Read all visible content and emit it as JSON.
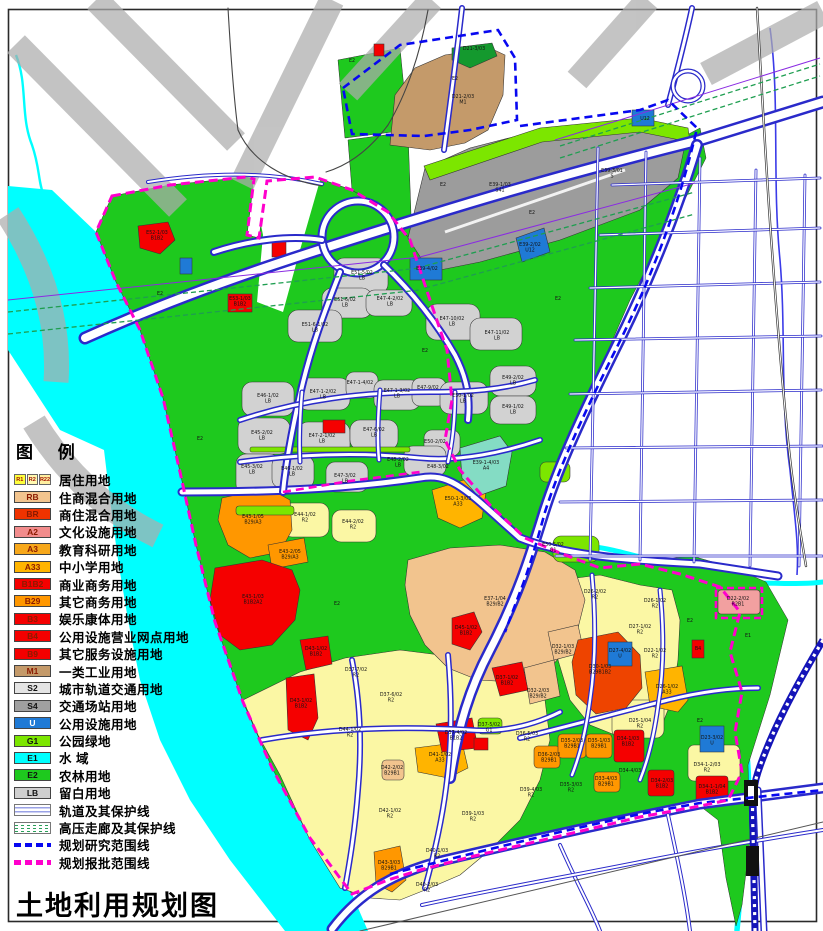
{
  "title": "土地利用规划图",
  "legend": {
    "title": "图 例",
    "items": [
      {
        "type": "swatch3",
        "codes": [
          "R1",
          "R2",
          "R22"
        ],
        "colors": [
          "#FFFF3C",
          "#FFF9B0",
          "#FFEFA0"
        ],
        "label": "居住用地"
      },
      {
        "type": "swatch",
        "code": "RB",
        "color": "#F2C48E",
        "label": "住商混合用地"
      },
      {
        "type": "swatch",
        "code": "BR",
        "color": "#F03300",
        "label": "商住混合用地"
      },
      {
        "type": "swatch",
        "code": "A2",
        "color": "#F28C8C",
        "label": "文化设施用地"
      },
      {
        "type": "swatch",
        "code": "A3",
        "color": "#F7A81B",
        "label": "教育科研用地"
      },
      {
        "type": "swatch",
        "code": "A33",
        "color": "#FFB400",
        "label": "中小学用地"
      },
      {
        "type": "swatch",
        "code": "B1B2",
        "color": "#F50000",
        "label": "商业商务用地"
      },
      {
        "type": "swatch",
        "code": "B29",
        "color": "#FF9700",
        "label": "其它商务用地"
      },
      {
        "type": "swatch",
        "code": "B3",
        "color": "#F50000",
        "label": "娱乐康体用地"
      },
      {
        "type": "swatch",
        "code": "B4",
        "color": "#F50000",
        "label": "公用设施营业网点用地"
      },
      {
        "type": "swatch",
        "code": "B9",
        "color": "#F50000",
        "label": "其它服务设施用地"
      },
      {
        "type": "swatch",
        "code": "M1",
        "color": "#C49A6A",
        "label": "一类工业用地"
      },
      {
        "type": "swatch",
        "code": "S2",
        "color": "#E4E4E4",
        "tc": "#111",
        "label": "城市轨道交通用地"
      },
      {
        "type": "swatch",
        "code": "S4",
        "color": "#A0A0A0",
        "tc": "#111",
        "label": "交通场站用地"
      },
      {
        "type": "swatch",
        "code": "U",
        "color": "#1F7AD6",
        "tc": "#fff",
        "label": "公用设施用地"
      },
      {
        "type": "swatch",
        "code": "G1",
        "color": "#7CE600",
        "tc": "#111",
        "label": "公园绿地"
      },
      {
        "type": "swatch",
        "code": "E1",
        "color": "#00FFFF",
        "tc": "#111",
        "label": "水  域"
      },
      {
        "type": "swatch",
        "code": "E2",
        "color": "#1EC91E",
        "tc": "#111",
        "label": "农林用地"
      },
      {
        "type": "swatch",
        "code": "LB",
        "color": "#CFCFCF",
        "tc": "#111",
        "label": "留白用地"
      },
      {
        "type": "rail",
        "label": "轨道及其保护线"
      },
      {
        "type": "hv",
        "label": "高压走廊及其保护线"
      },
      {
        "type": "dash",
        "color": "#0808F0",
        "label": "规划研究范围线"
      },
      {
        "type": "dash",
        "color": "#FF00CC",
        "label": "规划报批范围线"
      }
    ]
  },
  "colors": {
    "E2": "#1EC91E",
    "G1": "#7CE600",
    "E1": "#00FFFF",
    "LB": "#D2D2D2",
    "S4": "#9C9C9C",
    "M1": "#C49A6A",
    "DG": "#14992E",
    "R2": "#FBF7A4",
    "RB": "#F2C48E",
    "B1B2": "#F50000",
    "B29": "#FF9700",
    "BRR": "#EE4400",
    "A33": "#FFB400",
    "U": "#1F7AD6",
    "A4": "#84DCC4",
    "A2": "#F2A0A0",
    "watermark": "#ADADAD",
    "roadCasing": "#2A2ACA",
    "gridBlue": "#4646CE",
    "railBlue": "#1414B8",
    "hvGreen": "#1E9E50",
    "purple": "#8A2BE2",
    "boundaryBlue": "#0808F0",
    "boundaryMagenta": "#FF00CC",
    "frame": "#2A2A2A"
  },
  "map": {
    "labels": [
      {
        "x": 463,
        "y": 98,
        "t": "D21-2/03",
        "t2": "M1"
      },
      {
        "x": 474,
        "y": 50,
        "t": "D21-3/03"
      },
      {
        "x": 500,
        "y": 186,
        "t": "E39-1/03",
        "t2": "S41"
      },
      {
        "x": 612,
        "y": 172,
        "t": "E39-3/01",
        "t2": "S"
      },
      {
        "x": 530,
        "y": 246,
        "t": "E39-2/02",
        "t2": "U12"
      },
      {
        "x": 427,
        "y": 270,
        "t": "E39-4/02"
      },
      {
        "x": 645,
        "y": 120,
        "t": "U12"
      },
      {
        "x": 157,
        "y": 234,
        "t": "E52-1/03",
        "t2": "B1B2"
      },
      {
        "x": 240,
        "y": 300,
        "t": "E53-1/03",
        "t2": "B1B2"
      },
      {
        "x": 362,
        "y": 274,
        "t": "E51-5/02",
        "t2": "LB"
      },
      {
        "x": 345,
        "y": 301,
        "t": "E51-6/02",
        "t2": "LB"
      },
      {
        "x": 315,
        "y": 326,
        "t": "E51-6-1/02",
        "t2": "LB"
      },
      {
        "x": 390,
        "y": 300,
        "t": "E47-4-2/02",
        "t2": "LB"
      },
      {
        "x": 452,
        "y": 320,
        "t": "E47-10/02",
        "t2": "LB"
      },
      {
        "x": 497,
        "y": 334,
        "t": "E47-11/02",
        "t2": "LB"
      },
      {
        "x": 268,
        "y": 397,
        "t": "E46-1/02",
        "t2": "LB"
      },
      {
        "x": 323,
        "y": 393,
        "t": "E47-1-2/02",
        "t2": "LB"
      },
      {
        "x": 360,
        "y": 384,
        "t": "E47-1-4/02"
      },
      {
        "x": 397,
        "y": 392,
        "t": "E47-1-3/02",
        "t2": "LB"
      },
      {
        "x": 428,
        "y": 389,
        "t": "E47-9/02"
      },
      {
        "x": 463,
        "y": 397,
        "t": "E50-1/02",
        "t2": "LB"
      },
      {
        "x": 513,
        "y": 379,
        "t": "E49-2/02",
        "t2": "LB"
      },
      {
        "x": 262,
        "y": 434,
        "t": "E45-2/02",
        "t2": "LB"
      },
      {
        "x": 322,
        "y": 437,
        "t": "E47-2-1/02",
        "t2": "LB"
      },
      {
        "x": 374,
        "y": 431,
        "t": "E47-6/02",
        "t2": "LB"
      },
      {
        "x": 345,
        "y": 477,
        "t": "E47-3/02",
        "t2": "LB"
      },
      {
        "x": 252,
        "y": 468,
        "t": "E45-3/02",
        "t2": "LB"
      },
      {
        "x": 292,
        "y": 470,
        "t": "E46-1/02",
        "t2": "LB"
      },
      {
        "x": 398,
        "y": 461,
        "t": "E48-2/02",
        "t2": "LB"
      },
      {
        "x": 438,
        "y": 468,
        "t": "E48-3/02"
      },
      {
        "x": 435,
        "y": 443,
        "t": "E50-2/02"
      },
      {
        "x": 513,
        "y": 408,
        "t": "E49-1/02",
        "t2": "LB"
      },
      {
        "x": 553,
        "y": 546,
        "t": "E50-5/02",
        "t2": "G1"
      },
      {
        "x": 486,
        "y": 464,
        "t": "E39-1-4/03",
        "t2": "A4"
      },
      {
        "x": 458,
        "y": 500,
        "t": "E50-1-3/03",
        "t2": "A33"
      },
      {
        "x": 253,
        "y": 518,
        "t": "E43-1/05",
        "t2": "B29/A3"
      },
      {
        "x": 290,
        "y": 553,
        "t": "E43-2/05",
        "t2": "B29/A3"
      },
      {
        "x": 253,
        "y": 598,
        "t": "E43-1/03",
        "t2": "B1B2A2"
      },
      {
        "x": 305,
        "y": 516,
        "t": "E44-1/02",
        "t2": "R2"
      },
      {
        "x": 353,
        "y": 523,
        "t": "E44-2/02",
        "t2": "R2"
      },
      {
        "x": 466,
        "y": 629,
        "t": "D45-1/02",
        "t2": "B1B2"
      },
      {
        "x": 495,
        "y": 600,
        "t": "E37-1/04",
        "t2": "B29/B2"
      },
      {
        "x": 316,
        "y": 650,
        "t": "D43-1/02",
        "t2": "B1B2"
      },
      {
        "x": 301,
        "y": 702,
        "t": "D43-1/02",
        "t2": "B1B2"
      },
      {
        "x": 350,
        "y": 731,
        "t": "D44-1/02",
        "t2": "R2"
      },
      {
        "x": 356,
        "y": 671,
        "t": "D37-7/02",
        "t2": "R2"
      },
      {
        "x": 391,
        "y": 696,
        "t": "D37-6/02",
        "t2": "R2"
      },
      {
        "x": 507,
        "y": 679,
        "t": "D37-1/02",
        "t2": "B1B2"
      },
      {
        "x": 456,
        "y": 734,
        "t": "D37-4/02",
        "t2": "B1B2"
      },
      {
        "x": 489,
        "y": 726,
        "t": "D37-5/02",
        "t2": "G1"
      },
      {
        "x": 440,
        "y": 756,
        "t": "D41-1/02",
        "t2": "A33"
      },
      {
        "x": 392,
        "y": 769,
        "t": "D42-2/02",
        "t2": "B29B1"
      },
      {
        "x": 390,
        "y": 812,
        "t": "D42-1/02",
        "t2": "R2"
      },
      {
        "x": 473,
        "y": 815,
        "t": "D39-1/03",
        "t2": "R2"
      },
      {
        "x": 437,
        "y": 852,
        "t": "D40-1/03",
        "t2": "R2"
      },
      {
        "x": 427,
        "y": 886,
        "t": "D40-2/03",
        "t2": "R2"
      },
      {
        "x": 389,
        "y": 864,
        "t": "D43-3/03",
        "t2": "B29B1"
      },
      {
        "x": 531,
        "y": 791,
        "t": "D39-4/03",
        "t2": "R2"
      },
      {
        "x": 527,
        "y": 735,
        "t": "D36-5/03",
        "t2": "R2"
      },
      {
        "x": 549,
        "y": 756,
        "t": "D36-2/03",
        "t2": "B29B1"
      },
      {
        "x": 572,
        "y": 742,
        "t": "D35-2/03",
        "t2": "B29B1"
      },
      {
        "x": 599,
        "y": 742,
        "t": "D35-1/03",
        "t2": "B29B1"
      },
      {
        "x": 628,
        "y": 740,
        "t": "D34-1/03",
        "t2": "B1B2"
      },
      {
        "x": 571,
        "y": 786,
        "t": "D35-3/03",
        "t2": "R2"
      },
      {
        "x": 606,
        "y": 780,
        "t": "D33-4/03",
        "t2": "B29B1"
      },
      {
        "x": 600,
        "y": 668,
        "t": "D30-1/03",
        "t2": "B29B1B2"
      },
      {
        "x": 563,
        "y": 648,
        "t": "D32-1/03",
        "t2": "B29/B2"
      },
      {
        "x": 538,
        "y": 692,
        "t": "D32-2/03",
        "t2": "B29/B2"
      },
      {
        "x": 595,
        "y": 593,
        "t": "D26-2/02",
        "t2": "R2"
      },
      {
        "x": 655,
        "y": 602,
        "t": "D26-1/02",
        "t2": "R2"
      },
      {
        "x": 640,
        "y": 628,
        "t": "D27-1/02",
        "t2": "R2"
      },
      {
        "x": 655,
        "y": 652,
        "t": "D22-1/02",
        "t2": "R2"
      },
      {
        "x": 667,
        "y": 688,
        "t": "D26-1/02",
        "t2": "A33"
      },
      {
        "x": 640,
        "y": 722,
        "t": "D25-1/04",
        "t2": "R2"
      },
      {
        "x": 707,
        "y": 766,
        "t": "D34-1-2/03",
        "t2": "R2"
      },
      {
        "x": 630,
        "y": 772,
        "t": "D34-4/03"
      },
      {
        "x": 662,
        "y": 782,
        "t": "D34-2/03",
        "t2": "B1B2"
      },
      {
        "x": 712,
        "y": 788,
        "t": "D34-1-1/04",
        "t2": "B1B2"
      },
      {
        "x": 620,
        "y": 652,
        "t": "D27-4/02",
        "t2": "U"
      },
      {
        "x": 712,
        "y": 739,
        "t": "D23-3/02",
        "t2": "U"
      },
      {
        "x": 738,
        "y": 600,
        "t": "D22-2/02",
        "t2": "R2B1"
      },
      {
        "x": 698,
        "y": 650,
        "t": "B4"
      },
      {
        "x": 748,
        "y": 637,
        "t": "E1"
      },
      {
        "x": 160,
        "y": 295,
        "t": "E2"
      },
      {
        "x": 200,
        "y": 440,
        "t": "E2"
      },
      {
        "x": 425,
        "y": 352,
        "t": "E2"
      },
      {
        "x": 558,
        "y": 300,
        "t": "E2"
      },
      {
        "x": 337,
        "y": 605,
        "t": "E2"
      },
      {
        "x": 690,
        "y": 622,
        "t": "E2"
      },
      {
        "x": 700,
        "y": 722,
        "t": "E2"
      },
      {
        "x": 443,
        "y": 186,
        "t": "E2"
      },
      {
        "x": 532,
        "y": 214,
        "t": "E2"
      },
      {
        "x": 352,
        "y": 62,
        "t": "E2"
      },
      {
        "x": 455,
        "y": 80,
        "t": "E2"
      }
    ]
  }
}
